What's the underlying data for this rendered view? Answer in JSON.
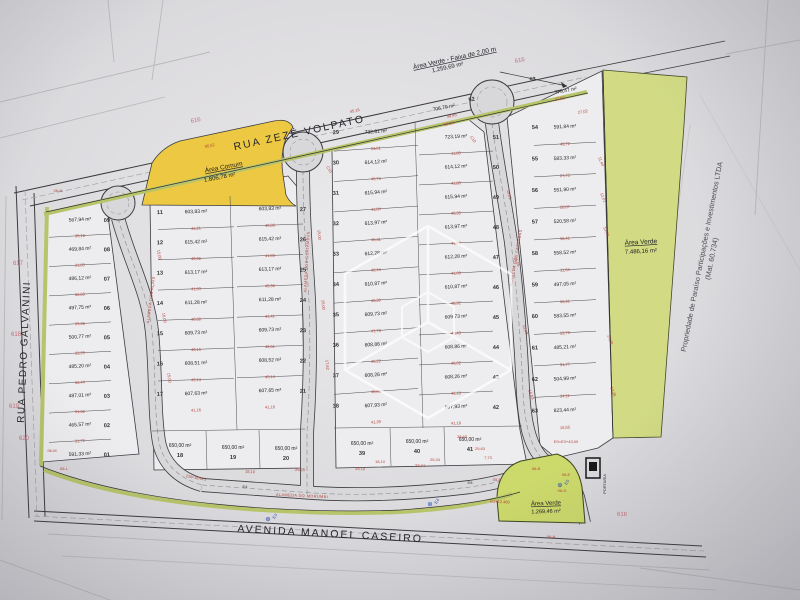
{
  "streets": {
    "top": "RUA ZEZÉ VOLPATO",
    "left": "RUA PEDRO GALVANINI",
    "bottom": "AVENIDA MANOEL CASEIRO",
    "alameda_1": "ALAMEDA DOS AÇAÍS",
    "alameda_2": "ALAMEDA DOS GUATAMBUS",
    "alameda_3": "ALAMEDA DOS CATUABAS",
    "alameda_4": "ALAMEDA DO MORUMBI"
  },
  "green_areas": {
    "faixa_label": "Área Verde - Faixa de 2,00 m",
    "faixa_area": "1.259,69 m²",
    "comum_label": "Área Comum",
    "comum_area": "1.806,78 m²",
    "right_label": "Área Verde",
    "right_area": "7.486,16 m²",
    "bottom_label": "Área Verde",
    "bottom_area": "1.269,46 m²"
  },
  "property_note": {
    "line1": "Propriedade de Paraíso Participações e Investimentos LTDA",
    "line2": "(Mat. 60.734)"
  },
  "portaria_label": "PORTARIA",
  "colors": {
    "green": "#ccd96b",
    "yellow": "#ecc843",
    "red": "#b5443a",
    "blue": "#2b50b8"
  },
  "blocks": {
    "a": [
      {
        "n": "09",
        "area": "567,94 m²",
        "dim": "30,18"
      },
      {
        "n": "08",
        "area": "469,84 m²",
        "dim": "31,85"
      },
      {
        "n": "07",
        "area": "486,12 m²",
        "dim": "32,89"
      },
      {
        "n": "06",
        "area": "497,75 m²",
        "dim": "33,38"
      },
      {
        "n": "05",
        "area": "500,77 m²",
        "dim": "33,29"
      },
      {
        "n": "04",
        "area": "485,20 m²",
        "dim": "32,44"
      },
      {
        "n": "03",
        "area": "487,01 m²",
        "dim": "31,62"
      },
      {
        "n": "02",
        "area": "465,57 m²",
        "dim": "31,72"
      },
      {
        "n": "01",
        "area": "591,33 m²",
        "dim": ""
      }
    ],
    "b_west": [
      {
        "n": "11",
        "area": "603,83 m²",
        "dim": "41,21"
      },
      {
        "n": "12",
        "area": "615,42 m²",
        "dim": "40,98"
      },
      {
        "n": "13",
        "area": "613,17 m²",
        "dim": "41,83"
      },
      {
        "n": "14",
        "area": "611,28 m²",
        "dim": "40,88"
      },
      {
        "n": "15",
        "area": "609,73 m²",
        "dim": "40,16"
      },
      {
        "n": "16",
        "area": "608,51 m²",
        "dim": "43,14"
      },
      {
        "n": "17",
        "area": "607,63 m²",
        "dim": "41,16"
      }
    ],
    "b_east": [
      {
        "n": "27",
        "area": "603,83 m²",
        "dim": "40,88"
      },
      {
        "n": "26",
        "area": "615,42 m²",
        "dim": "41,83"
      },
      {
        "n": "25",
        "area": "613,17 m²",
        "dim": "40,98"
      },
      {
        "n": "24",
        "area": "611,28 m²",
        "dim": "41,41"
      },
      {
        "n": "23",
        "area": "609,73 m²",
        "dim": "42,51"
      },
      {
        "n": "22",
        "area": "608,52 m²",
        "dim": "43,14"
      },
      {
        "n": "21",
        "area": "607,65 m²",
        "dim": "41,16"
      }
    ],
    "b_bottom": [
      {
        "n": "18",
        "area": "650,00 m²",
        "dim": ""
      },
      {
        "n": "19",
        "area": "650,00 m²",
        "dim": ""
      },
      {
        "n": "20",
        "area": "650,00 m²",
        "dim": ""
      }
    ],
    "c_west": [
      {
        "n": "29",
        "area": "732,81 m²",
        "dim": "23,01"
      },
      {
        "n": "30",
        "area": "614,12 m²",
        "dim": "46,76"
      },
      {
        "n": "31",
        "area": "615,94 m²",
        "dim": "41,84"
      },
      {
        "n": "32",
        "area": "613,97 m²",
        "dim": "40,31"
      },
      {
        "n": "33",
        "area": "612,28 m²",
        "dim": "40,44"
      },
      {
        "n": "34",
        "area": "610,87 m²",
        "dim": "40,30"
      },
      {
        "n": "35",
        "area": "609,73 m²",
        "dim": "41,78"
      },
      {
        "n": "36",
        "area": "608,86 m²",
        "dim": "40,22"
      },
      {
        "n": "37",
        "area": "608,26 m²",
        "dim": "40,00"
      },
      {
        "n": "38",
        "area": "607,93 m²",
        "dim": "41,39"
      }
    ],
    "c_east": [
      {
        "n": "51",
        "area": "723,19 m²",
        "dim": "11,80"
      },
      {
        "n": "50",
        "area": "614,12 m²",
        "dim": "41,80"
      },
      {
        "n": "49",
        "area": "615,94 m²",
        "dim": "40,35"
      },
      {
        "n": "48",
        "area": "613,97 m²",
        "dim": "41,43"
      },
      {
        "n": "47",
        "area": "612,28 m²",
        "dim": "41,09"
      },
      {
        "n": "46",
        "area": "610,87 m²",
        "dim": "40,92"
      },
      {
        "n": "45",
        "area": "609,73 m²",
        "dim": "40,43"
      },
      {
        "n": "44",
        "area": "608,86 m²",
        "dim": "40,02"
      },
      {
        "n": "43",
        "area": "608,26 m²",
        "dim": "42,18"
      },
      {
        "n": "42",
        "area": "607,93 m²",
        "dim": "41,18"
      }
    ],
    "c_bottom": [
      {
        "n": "39",
        "area": "650,00 m²",
        "dim": "18,10"
      },
      {
        "n": "40",
        "area": "650,00 m²",
        "dim": "25,34"
      },
      {
        "n": "41",
        "area": "650,00 m²",
        "dim": "7,73"
      }
    ],
    "d": [
      {
        "n": "54",
        "area": "591,84 m²",
        "dim": "49,72"
      },
      {
        "n": "55",
        "area": "583,33 m²",
        "dim": "27,75"
      },
      {
        "n": "56",
        "area": "551,90 m²",
        "dim": "28,87"
      },
      {
        "n": "57",
        "area": "520,58 m²",
        "dim": "36,41"
      },
      {
        "n": "58",
        "area": "558,52 m²",
        "dim": "11,64"
      },
      {
        "n": "59",
        "area": "497,05 m²",
        "dim": "32,91"
      },
      {
        "n": "60",
        "area": "583,55 m²",
        "dim": "33,79"
      },
      {
        "n": "61",
        "area": "485,21 m²",
        "dim": "31,77"
      },
      {
        "n": "62",
        "area": "504,99 m²",
        "dim": "34,11"
      },
      {
        "n": "63",
        "area": "823,44 m²",
        "dim": "15,55"
      }
    ],
    "top_lots": [
      {
        "n": "52",
        "area": "706,79 m²"
      },
      {
        "n": "53",
        "area": "775,47 m²"
      }
    ]
  },
  "stakes": [
    {
      "t": "616",
      "x": 196,
      "y": 122,
      "r": -12
    },
    {
      "t": "616",
      "x": 520,
      "y": 62,
      "r": -12
    },
    {
      "t": "617",
      "x": 18,
      "y": 265,
      "r": 0
    },
    {
      "t": "618",
      "x": 16,
      "y": 336,
      "r": 0
    },
    {
      "t": "619",
      "x": 14,
      "y": 408,
      "r": 0
    },
    {
      "t": "620",
      "x": 24,
      "y": 440,
      "r": 0
    },
    {
      "t": "616",
      "x": 622,
      "y": 516,
      "r": 2
    }
  ],
  "stations_blue": [
    {
      "t": "E3",
      "x": 268,
      "y": 521
    },
    {
      "t": "E4",
      "x": 430,
      "y": 506
    },
    {
      "t": "E5",
      "x": 560,
      "y": 487
    }
  ],
  "stations_black": [
    {
      "t": "E4",
      "x": 245,
      "y": 488
    },
    {
      "t": "E8",
      "x": 470,
      "y": 484
    }
  ],
  "ref_notes": [
    {
      "t": "EN=18.673",
      "x": 196,
      "y": 479,
      "r": 10
    },
    {
      "t": "E9=E3+43,00",
      "x": 566,
      "y": 443,
      "r": 0
    },
    {
      "t": "E1+12.480",
      "x": 500,
      "y": 503,
      "r": 3
    }
  ],
  "curve_labels": [
    {
      "t": "C10",
      "x": 328,
      "y": 170,
      "r": 60
    },
    {
      "t": "C10",
      "x": 472,
      "y": 140,
      "r": 55
    }
  ],
  "corner_labels": [
    {
      "t": "06-N",
      "x": 58,
      "y": 192
    },
    {
      "t": "06-M",
      "x": 52,
      "y": 452
    },
    {
      "t": "06-L",
      "x": 64,
      "y": 470
    },
    {
      "t": "06-B",
      "x": 536,
      "y": 470
    },
    {
      "t": "06-E",
      "x": 566,
      "y": 476
    },
    {
      "t": "06-D",
      "x": 562,
      "y": 492
    },
    {
      "t": "06-A",
      "x": 551,
      "y": 538
    },
    {
      "t": "05-E",
      "x": 497,
      "y": 481
    }
  ],
  "dims_scatter": [
    {
      "t": "95,52",
      "x": 210,
      "y": 147,
      "r": -12
    },
    {
      "t": "45,16",
      "x": 355,
      "y": 112,
      "r": -12
    },
    {
      "t": "49,45",
      "x": 452,
      "y": 117,
      "r": -12
    },
    {
      "t": "58,98",
      "x": 449,
      "y": 125,
      "r": -12
    },
    {
      "t": "37,02",
      "x": 560,
      "y": 100,
      "r": -11
    },
    {
      "t": "27,02",
      "x": 583,
      "y": 113,
      "r": -10
    },
    {
      "t": "15,00",
      "x": 158,
      "y": 255,
      "r": 80
    },
    {
      "t": "16,00",
      "x": 163,
      "y": 318,
      "r": 80
    },
    {
      "t": "15,00",
      "x": 168,
      "y": 378,
      "r": 81
    },
    {
      "t": "15,00",
      "x": 318,
      "y": 235,
      "r": 84
    },
    {
      "t": "15,00",
      "x": 322,
      "y": 305,
      "r": 84
    },
    {
      "t": "17,62",
      "x": 326,
      "y": 365,
      "r": 84
    },
    {
      "t": "15,01",
      "x": 508,
      "y": 195,
      "r": 75
    },
    {
      "t": "15,05",
      "x": 516,
      "y": 262,
      "r": 73
    },
    {
      "t": "15,43",
      "x": 524,
      "y": 330,
      "r": 72
    },
    {
      "t": "16,03",
      "x": 530,
      "y": 395,
      "r": 70
    },
    {
      "t": "11,44",
      "x": 600,
      "y": 162,
      "r": 68
    },
    {
      "t": "12,01",
      "x": 602,
      "y": 198,
      "r": 68
    },
    {
      "t": "13,79",
      "x": 605,
      "y": 232,
      "r": 68
    },
    {
      "t": "17,28",
      "x": 609,
      "y": 340,
      "r": 68
    },
    {
      "t": "14,36",
      "x": 612,
      "y": 392,
      "r": 68
    },
    {
      "t": "18,10",
      "x": 250,
      "y": 473,
      "r": 3
    },
    {
      "t": "25,25",
      "x": 300,
      "y": 471,
      "r": 2
    },
    {
      "t": "25,10",
      "x": 360,
      "y": 470,
      "r": 2
    },
    {
      "t": "23,74",
      "x": 420,
      "y": 467,
      "r": 2
    },
    {
      "t": "38,63",
      "x": 462,
      "y": 438,
      "r": 0
    },
    {
      "t": "29,63",
      "x": 480,
      "y": 450,
      "r": 0
    }
  ]
}
